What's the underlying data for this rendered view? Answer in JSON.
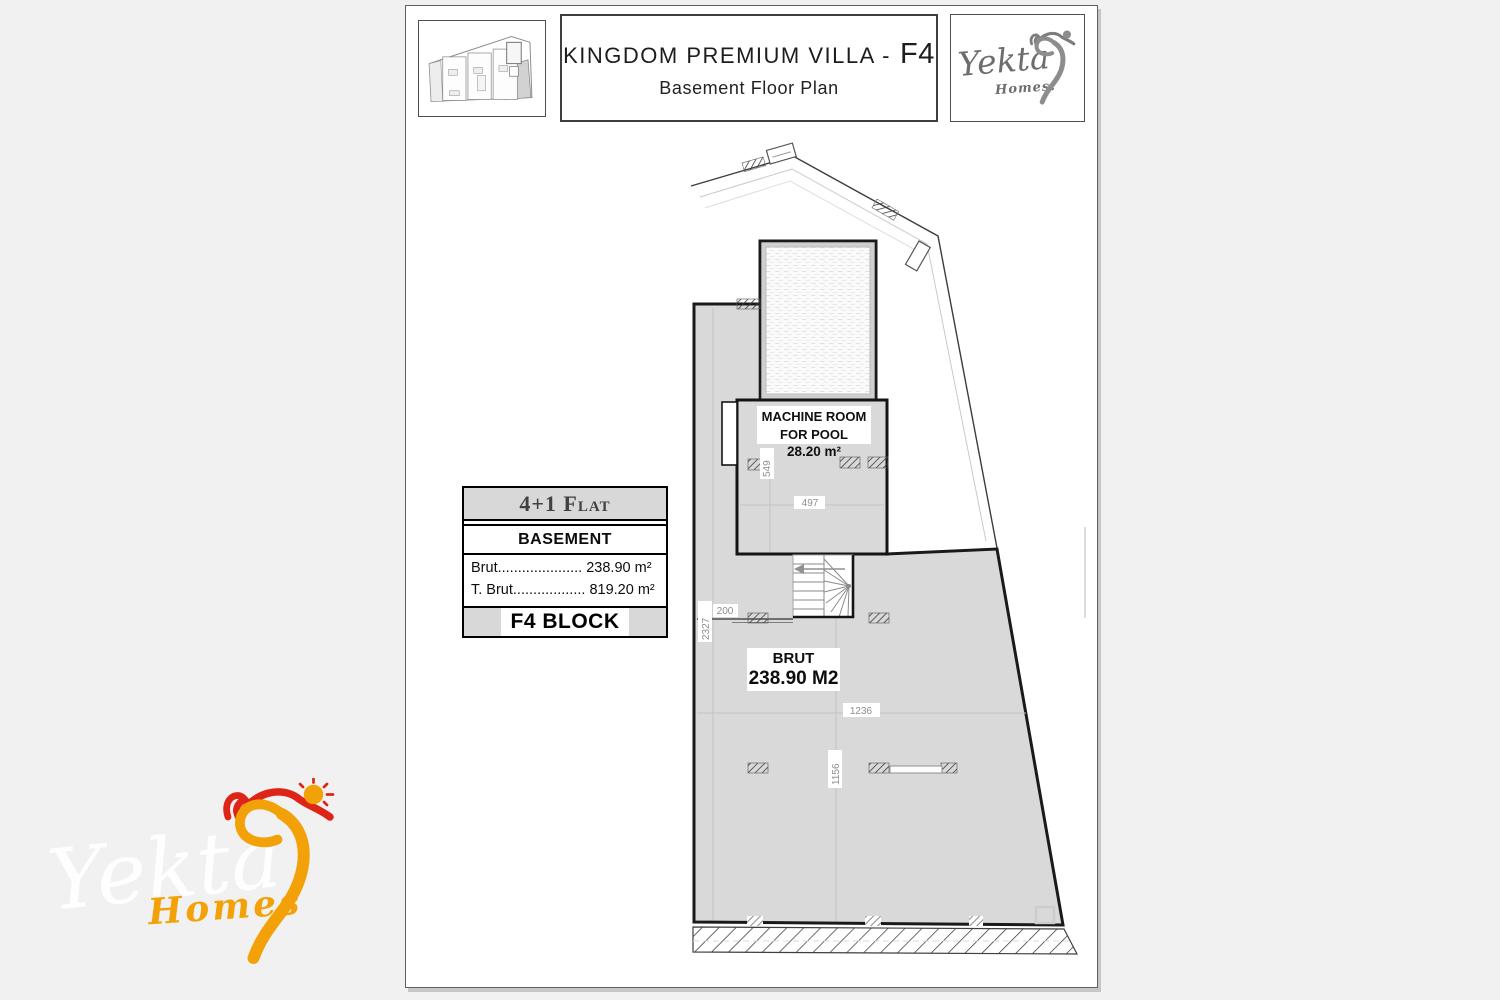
{
  "header": {
    "title": "KINGDOM PREMIUM VILLA -",
    "block_code": "F4",
    "subtitle": "Basement Floor Plan"
  },
  "brand": {
    "name": "Yekta",
    "homes": "Homes."
  },
  "watermark": {
    "name": "Yekta",
    "homes": "Homes"
  },
  "info_table": {
    "flat_type": "4+1 Flat",
    "floor": "BASEMENT",
    "brut_label": "Brut",
    "brut_leader": ".....................",
    "brut_value": " 238.90 m²",
    "tbrut_label": "T. Brut",
    "tbrut_leader": "..................",
    "tbrut_value": " 819.20 m²",
    "block": "F4 BLOCK"
  },
  "plan": {
    "machine_room_line1": "MACHINE ROOM",
    "machine_room_line2": "FOR POOL",
    "machine_room_area": "28.20 m²",
    "brut_label": "BRUT",
    "brut_value": "238.90 M2",
    "dims": {
      "d549": "549",
      "d497": "497",
      "d2327": "2327",
      "d200": "200",
      "d1236": "1236",
      "d1156": "1156"
    }
  },
  "colors": {
    "accent_orange": "#F2A208",
    "accent_red": "#DD2417",
    "plan_fill": "#d9d9d9",
    "wall": "#1a1a1a",
    "table_gray": "#d8d8d8"
  }
}
